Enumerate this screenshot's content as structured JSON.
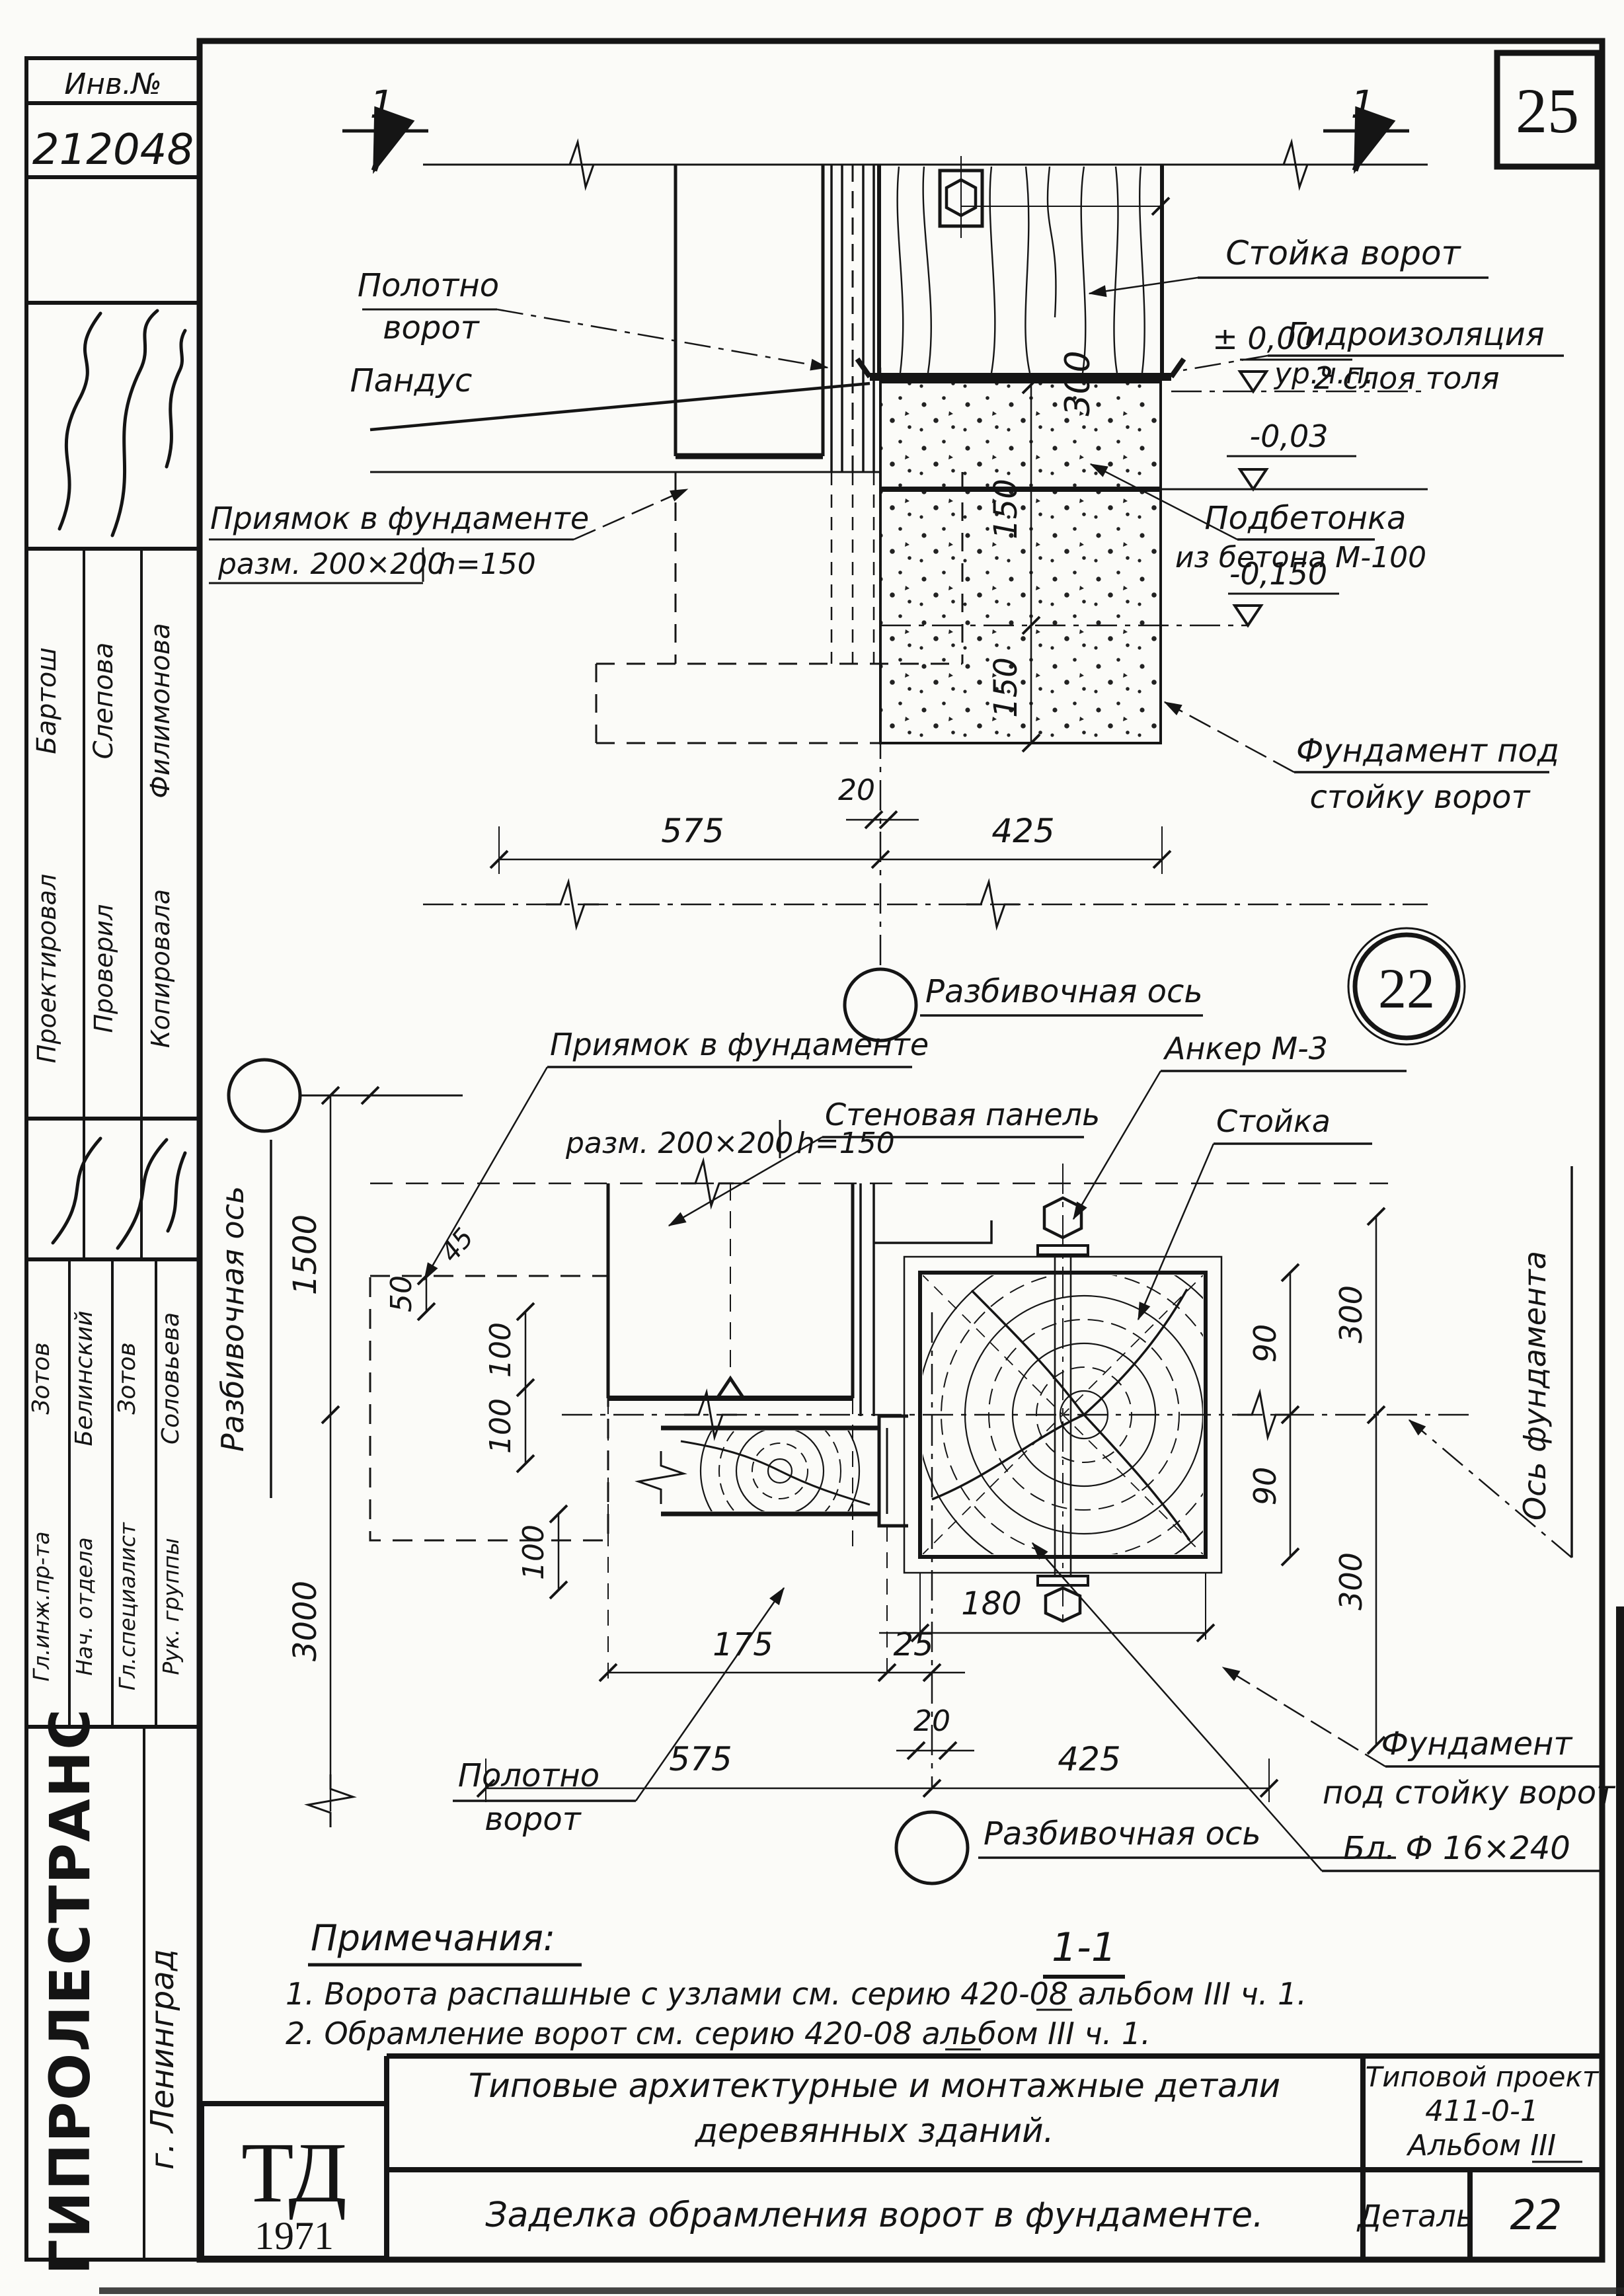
{
  "meta": {
    "inv_label": "Инв.№",
    "inv_number": "212048",
    "page_number": "25"
  },
  "sidebar": {
    "top_roles": [
      {
        "role": "Проектировал",
        "name": "Бартош"
      },
      {
        "role": "Проверил",
        "name": "Слепова"
      },
      {
        "role": "Копировала",
        "name": "Филимонова"
      }
    ],
    "bottom_roles": [
      {
        "role": "Гл.инж.пр-та",
        "name": "Зотов"
      },
      {
        "role": "Нач. отдела",
        "name": "Белинский"
      },
      {
        "role": "Гл.специалист",
        "name": "Зотов"
      },
      {
        "role": "Рук. группы",
        "name": "Соловьева"
      }
    ],
    "org": "ГИПРОЛЕСТРАНС",
    "city": "г. Ленинград"
  },
  "section_view": {
    "cut_mark": "1",
    "labels": {
      "polotno1": "Полотно",
      "polotno2": "ворот",
      "pandus": "Пандус",
      "priyamok1": "Приямок в фундаменте",
      "priyamok2": "разм. 200×200",
      "priyamok3": "h=150",
      "stoika": "Стойка ворот",
      "gidro1": "Гидроизоляция",
      "gidro2": "2 слоя толя",
      "lvl_zero": "± 0,00",
      "urchp": "ур.ч.п.",
      "lvl_003": "-0,03",
      "podbet1": "Подбетонка",
      "podbet2": "из бетона М-100",
      "lvl_0150": "-0,150",
      "fund1": "Фундамент под",
      "fund2": "стойку ворот",
      "axis": "Разбивочная ось"
    },
    "dims": {
      "w300": "300",
      "h150a": "150",
      "h150b": "150",
      "g20": "20",
      "w575": "575",
      "w425": "425"
    }
  },
  "plan_view": {
    "detail_circle": "22",
    "labels": {
      "axis_left": "Разбивочная ось",
      "priyamok1": "Приямок в фундаменте",
      "priyamok2": "разм. 200×200",
      "priyamok3": "h=150",
      "sten_panel": "Стеновая панель",
      "anker": "Анкер М-3",
      "stoika": "Стойка",
      "os_fund": "Ось фундамента",
      "fund1": "Фундамент",
      "fund2": "под стойку ворот",
      "blok": "Бл. Ф 16×240",
      "polotno1": "Полотно",
      "polotno2": "ворот",
      "axis_bottom": "Разбивочная ось",
      "section_title": "1-1"
    },
    "dims": {
      "v1500": "1500",
      "v3000": "3000",
      "v50": "50",
      "v45": "45",
      "v100a": "100",
      "v100b": "100",
      "v100c": "100",
      "v90a": "90",
      "v90b": "90",
      "v300a": "300",
      "v300b": "300",
      "h175": "175",
      "h25": "25",
      "h20": "20",
      "h180": "180",
      "h575": "575",
      "h425": "425"
    }
  },
  "notes": {
    "heading": "Примечания:",
    "items": [
      "1. Ворота распашные с узлами см. серию 420-08 альбом III ч. 1.",
      "2. Обрамление ворот см. серию 420-08 альбом III ч. 1."
    ]
  },
  "titleblock": {
    "logo": "ТД",
    "year": "1971",
    "series1": "Типовые архитектурные и монтажные детали",
    "series2": "деревянных зданий.",
    "sheet_title": "Заделка обрамления ворот в фундаменте.",
    "project1": "Типовой проект",
    "project2": "411-0-1",
    "project3": "Альбом III",
    "detail_label": "Деталь",
    "detail_number": "22"
  }
}
